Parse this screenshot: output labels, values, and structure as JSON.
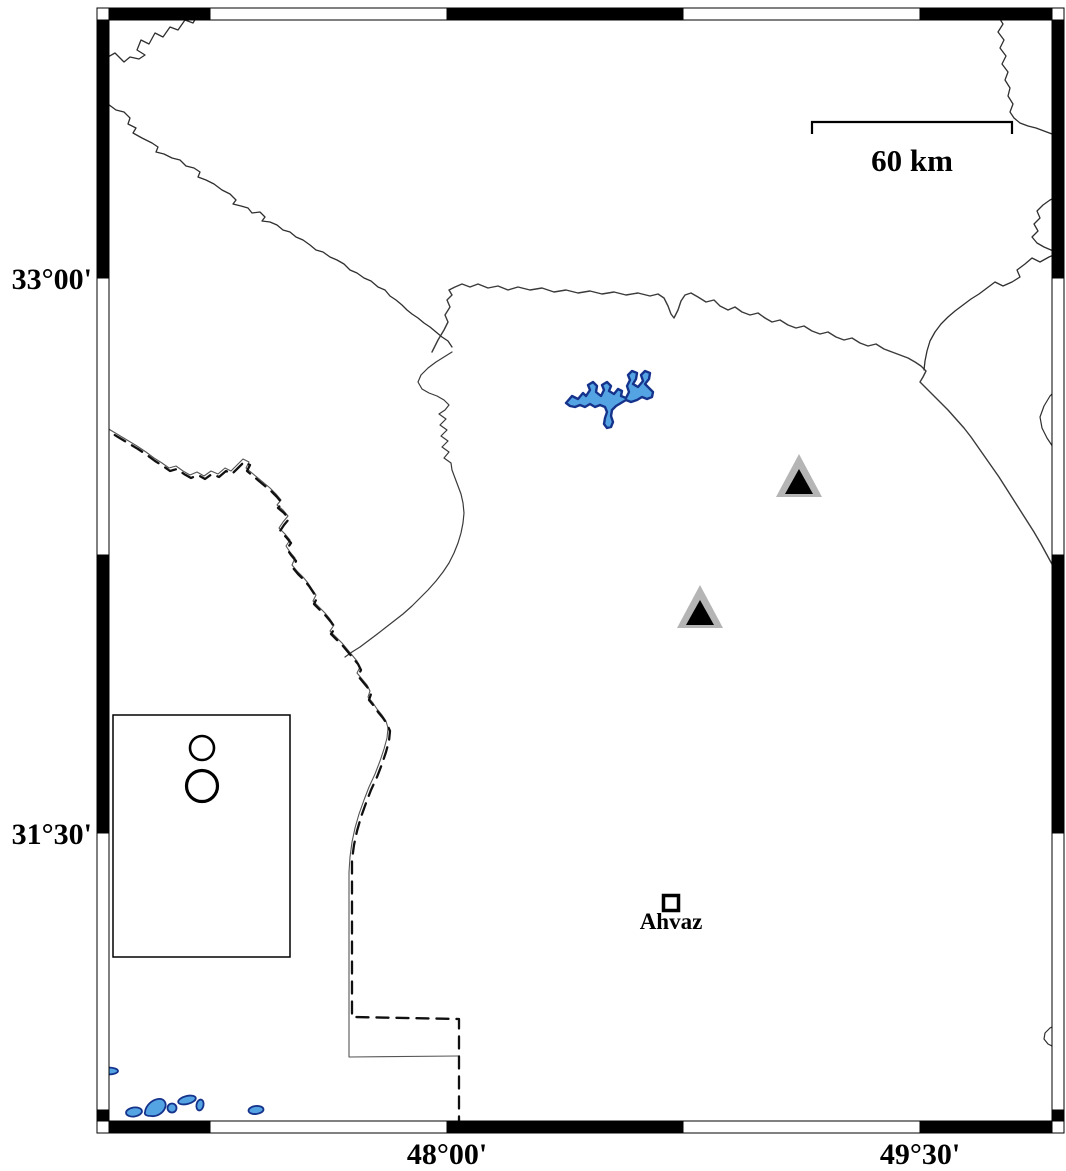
{
  "map": {
    "type": "geographic-map",
    "region_hint": "Khuzestan / Ahvaz area",
    "frame": {
      "lat_labels": [
        {
          "text": "33°00'",
          "y": 278
        },
        {
          "text": "31°30'",
          "y": 833
        }
      ],
      "lon_labels": [
        {
          "text": "48°00'",
          "x": 447
        },
        {
          "text": "49°30'",
          "x": 920
        }
      ],
      "band_thickness_px": 12,
      "outer_rect": {
        "x": 97,
        "y": 8,
        "width": 967,
        "height": 1125
      }
    },
    "scale_bar": {
      "label": "60 km",
      "x1": 812,
      "x2": 1012,
      "y": 122,
      "length_km": 60
    },
    "city": {
      "name": "Ahvaz",
      "x": 671,
      "y": 903,
      "marker": "open-square"
    },
    "stations": [
      {
        "x": 799,
        "y": 477
      },
      {
        "x": 700,
        "y": 608
      }
    ],
    "legend": {
      "x": 113,
      "y": 715,
      "width": 177,
      "height": 242,
      "circles": [
        {
          "cx": 202,
          "cy": 748,
          "r": 12,
          "stroke_width": 2.6
        },
        {
          "cx": 202,
          "cy": 786,
          "r": 15.5,
          "stroke_width": 3.2
        }
      ]
    },
    "water_bodies": {
      "lake_label": "reservoir",
      "small_ponds_count": 7
    },
    "colors": {
      "water_fill": "#54a4e4",
      "water_stroke": "#16338c",
      "station_gray": "#b5b5b5",
      "frame_black": "#000000",
      "line_dark": "#2f2f2f"
    }
  }
}
